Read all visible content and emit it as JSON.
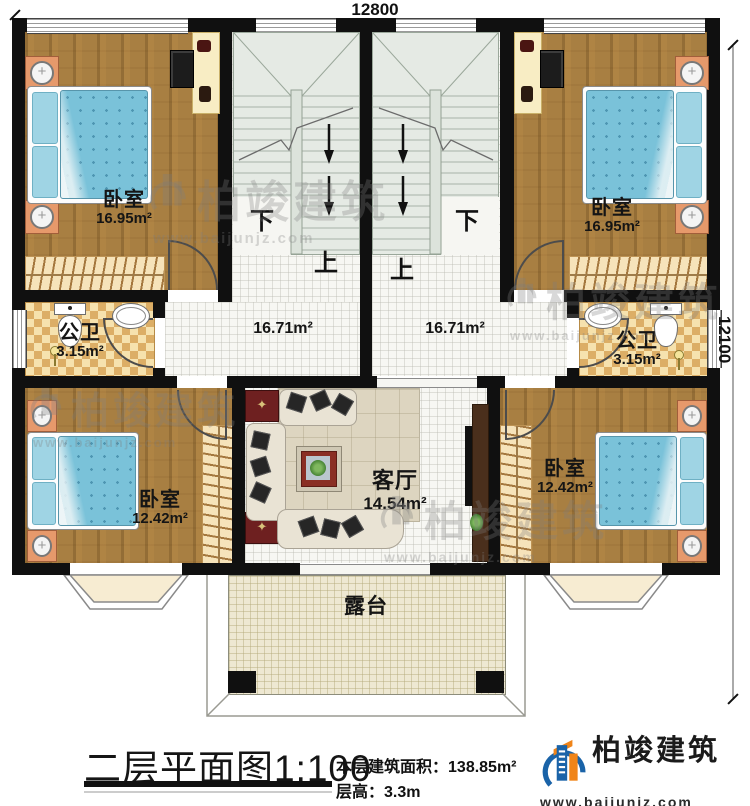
{
  "dimensions": {
    "top": "12800",
    "right": "12100"
  },
  "rooms": {
    "bedroom_tl": {
      "name": "卧室",
      "area": "16.95m²"
    },
    "bedroom_tr": {
      "name": "卧室",
      "area": "16.95m²"
    },
    "bath_l": {
      "name": "公卫",
      "area": "3.15m²"
    },
    "bath_r": {
      "name": "公卫",
      "area": "3.15m²"
    },
    "hall_l": {
      "area": "16.71m²"
    },
    "hall_r": {
      "area": "16.71m²"
    },
    "living": {
      "name": "客厅",
      "area": "14.54m²"
    },
    "bedroom_bl": {
      "name": "卧室",
      "area": "12.42m²"
    },
    "bedroom_br": {
      "name": "卧室",
      "area": "12.42m²"
    },
    "terrace": {
      "name": "露台"
    }
  },
  "stairs": {
    "down": "下",
    "up": "上"
  },
  "title": {
    "name": "二层平面图",
    "scale": "1:100",
    "area_label": "本层建筑面积：",
    "area_value": "138.85m²",
    "height_label": "层高：",
    "height_value": "3.3m"
  },
  "brand": {
    "name": "柏竣建筑",
    "url": "www.baijunjz.com"
  },
  "watermark": {
    "name": "柏竣建筑",
    "url": "www.baijunjz.com"
  }
}
